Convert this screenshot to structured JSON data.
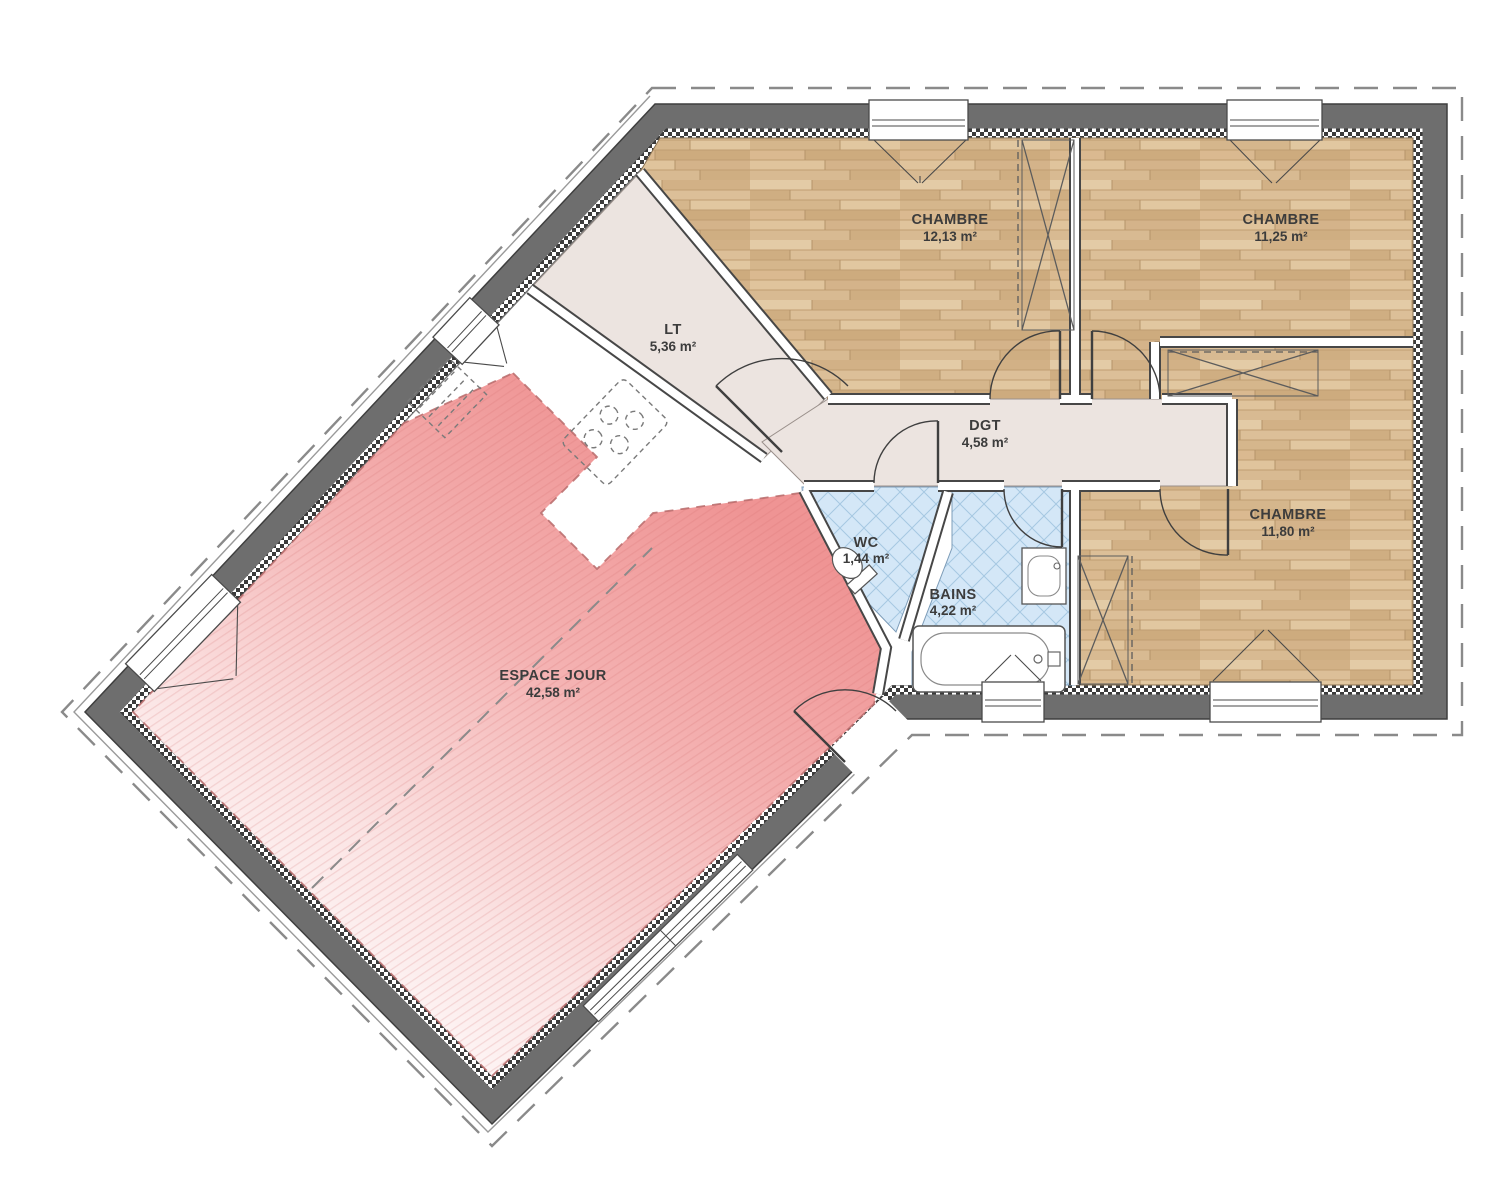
{
  "plan": {
    "type": "floor-plan",
    "rooms": [
      {
        "name": "CHAMBRE",
        "area": "12,13 m²"
      },
      {
        "name": "CHAMBRE",
        "area": "11,25 m²"
      },
      {
        "name": "CHAMBRE",
        "area": "11,80 m²"
      },
      {
        "name": "LT",
        "area": "5,36 m²"
      },
      {
        "name": "DGT",
        "area": "4,58 m²"
      },
      {
        "name": "WC",
        "area": "1,44 m²"
      },
      {
        "name": "BAINS",
        "area": "4,22 m²"
      },
      {
        "name": "ESPACE JOUR",
        "area": "42,58 m²"
      }
    ],
    "colors": {
      "wall": "#6e6e6e",
      "wood_floor": "#d9bb92",
      "tile_floor": "#d4e7f7",
      "living_highlight": "#ef9494",
      "hall_floor": "#ece4e0",
      "label_text": "#3c3c3c"
    }
  }
}
